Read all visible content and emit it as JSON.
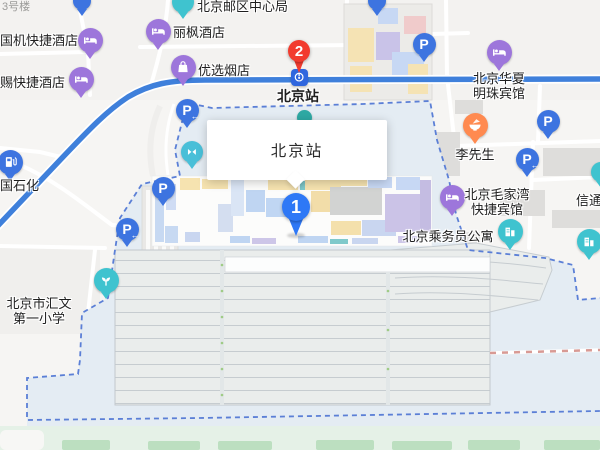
{
  "app": {
    "type": "map-view",
    "place": "北京站"
  },
  "colors": {
    "road_blue": "#3F80DB",
    "boundary_dash": "#5B7FD6",
    "precinct_fill": "#E4ECF3",
    "platform_fill": "#EAEDEC",
    "green_area": "#E5F1E7",
    "rail_dash": "#D89A94",
    "poi_purple": "#9D76DB",
    "poi_teal": "#3FC3CF",
    "poi_blue": "#3D74E0",
    "poi_orange": "#FF8A50",
    "poi_cyan": "#49BFD8",
    "metro_blue": "#2F66DE",
    "pin_red": "#F23B2E",
    "pin_blue": "#2E78F6"
  },
  "infobox": {
    "title": "北京站",
    "x": 207,
    "y": 120,
    "w": 180,
    "h": 60
  },
  "map": {
    "pins": [
      {
        "id": "pin-2",
        "number": "2",
        "color": "#F23B2E",
        "x": 299,
        "y": 51,
        "r": 11,
        "tail": 11,
        "font": 15
      },
      {
        "id": "pin-1",
        "number": "1",
        "color": "#2E78F6",
        "x": 296,
        "y": 207,
        "r": 14,
        "tail": 15,
        "font": 18,
        "shadow": true
      }
    ],
    "pois": [
      {
        "id": "poi-top-left-cut",
        "type": "plain",
        "color": "#3D74E0",
        "x": 82,
        "y": 1,
        "size": 18
      },
      {
        "id": "hotel-guoji",
        "type": "hotel",
        "x": 90,
        "y": 40,
        "labels": [
          {
            "lines": [
              "国机快捷酒店"
            ],
            "x": 0,
            "y": 40,
            "align": "left"
          }
        ]
      },
      {
        "id": "hotel-ci",
        "type": "hotel",
        "x": 81,
        "y": 79,
        "labels": [
          {
            "lines": [
              "赐快捷酒店"
            ],
            "x": 0,
            "y": 82,
            "align": "left"
          }
        ]
      },
      {
        "id": "label-3haolou",
        "type": "label-only",
        "labels": [
          {
            "lines": [
              "3号楼"
            ],
            "x": 2,
            "y": 7,
            "align": "left",
            "color": "#9B9B99",
            "size": 11
          }
        ]
      },
      {
        "id": "post-hub",
        "type": "plain",
        "color": "#3FC3CF",
        "x": 183,
        "y": 2,
        "size": 22,
        "labels": [
          {
            "lines": [
              "北京邮区中心局"
            ],
            "x": 197,
            "y": 6,
            "align": "left"
          }
        ]
      },
      {
        "id": "hotel-lifeng",
        "type": "hotel",
        "x": 158,
        "y": 31,
        "labels": [
          {
            "lines": [
              "丽枫酒店"
            ],
            "x": 173,
            "y": 32,
            "align": "left"
          }
        ]
      },
      {
        "id": "shop-youxuan",
        "type": "shop",
        "x": 183,
        "y": 67,
        "labels": [
          {
            "lines": [
              "优选烟店"
            ],
            "x": 198,
            "y": 70,
            "align": "left"
          }
        ]
      },
      {
        "id": "poi-top-right-cut",
        "type": "plain",
        "color": "#3D74E0",
        "x": 377,
        "y": 1,
        "size": 18
      },
      {
        "id": "parking-northeast",
        "type": "parking",
        "x": 424,
        "y": 44
      },
      {
        "id": "hotel-huaxia",
        "type": "hotel",
        "x": 499,
        "y": 52,
        "labels": [
          {
            "lines": [
              "北京华夏",
              "明珠宾馆"
            ],
            "x": 499,
            "y": 86,
            "align": "center"
          }
        ]
      },
      {
        "id": "metro-beijingzhan",
        "type": "metro",
        "x": 299,
        "y": 77,
        "labels": [
          {
            "lines": [
              "北京站"
            ],
            "x": 298,
            "y": 96,
            "align": "center",
            "bold": true,
            "size": 14
          }
        ]
      },
      {
        "id": "parking-east",
        "type": "parking",
        "x": 548,
        "y": 121
      },
      {
        "id": "food-lixiansheng",
        "type": "food",
        "x": 475,
        "y": 125,
        "labels": [
          {
            "lines": [
              "李先生"
            ],
            "x": 475,
            "y": 154,
            "align": "center"
          }
        ]
      },
      {
        "id": "parking-east-arrow",
        "type": "parking-arrow",
        "x": 527,
        "y": 159
      },
      {
        "id": "poi-xintong-cut",
        "type": "plain",
        "color": "#3FC3CF",
        "x": 601,
        "y": 172,
        "size": 20,
        "labels": [
          {
            "lines": [
              "信通"
            ],
            "x": 576,
            "y": 200,
            "align": "left"
          }
        ]
      },
      {
        "id": "hotel-maojiawan",
        "type": "hotel",
        "x": 452,
        "y": 197,
        "labels": [
          {
            "lines": [
              "北京毛家湾",
              "快捷宾馆"
            ],
            "x": 497,
            "y": 202,
            "align": "center"
          }
        ]
      },
      {
        "id": "apartment-chengwuyuan",
        "type": "building",
        "x": 510,
        "y": 231,
        "labels": [
          {
            "lines": [
              "北京乘务员公寓"
            ],
            "x": 448,
            "y": 236,
            "align": "center"
          }
        ]
      },
      {
        "id": "building-east",
        "type": "building",
        "x": 589,
        "y": 241
      },
      {
        "id": "gas-sinopec",
        "type": "gas",
        "x": 10,
        "y": 162,
        "labels": [
          {
            "lines": [
              "国石化"
            ],
            "x": 0,
            "y": 185,
            "align": "left"
          }
        ]
      },
      {
        "id": "parking-plaza-arrow",
        "type": "parking-arrow",
        "x": 187,
        "y": 110
      },
      {
        "id": "gate-ticket",
        "type": "gate",
        "x": 192,
        "y": 152,
        "size": 22
      },
      {
        "id": "parking-west",
        "type": "parking",
        "x": 163,
        "y": 188
      },
      {
        "id": "parking-southwest-arrow",
        "type": "parking-arrow",
        "x": 127,
        "y": 229
      },
      {
        "id": "poi-covered",
        "type": "plain",
        "color": "#2EA9A4",
        "x": 304,
        "y": 117,
        "size": 15,
        "z": 5
      },
      {
        "id": "school-huiwen",
        "type": "sprout",
        "x": 106,
        "y": 280,
        "labels": [
          {
            "lines": [
              "北京市汇文",
              "第一小学"
            ],
            "x": 39,
            "y": 311,
            "align": "center"
          }
        ]
      }
    ]
  }
}
